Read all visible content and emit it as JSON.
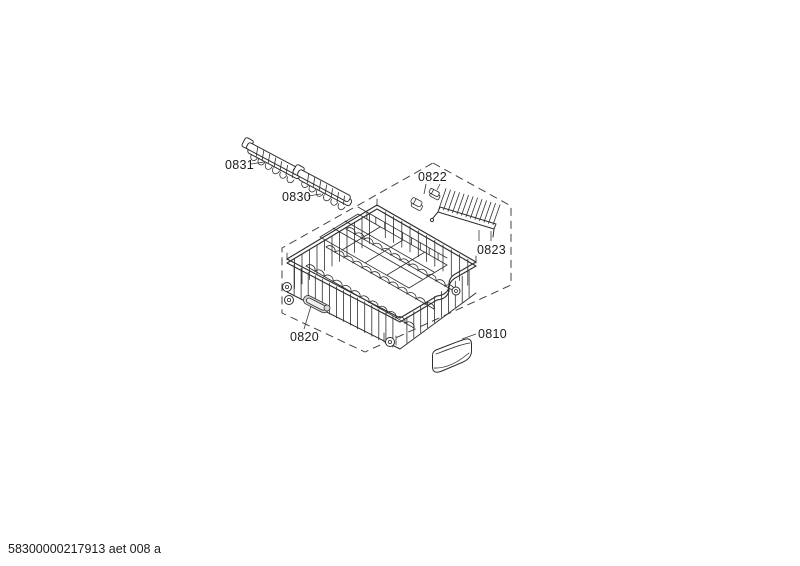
{
  "footer": {
    "doc_number": "58300000217913 aet 008 a"
  },
  "diagram": {
    "labels": {
      "part_0831": "0831",
      "part_0830": "0830",
      "part_0822": "0822",
      "part_0823": "0823",
      "part_0820": "0820",
      "part_0810": "0810"
    },
    "colors": {
      "line": "#2e2e2e",
      "shade": "#dadada",
      "background": "#ffffff"
    }
  }
}
